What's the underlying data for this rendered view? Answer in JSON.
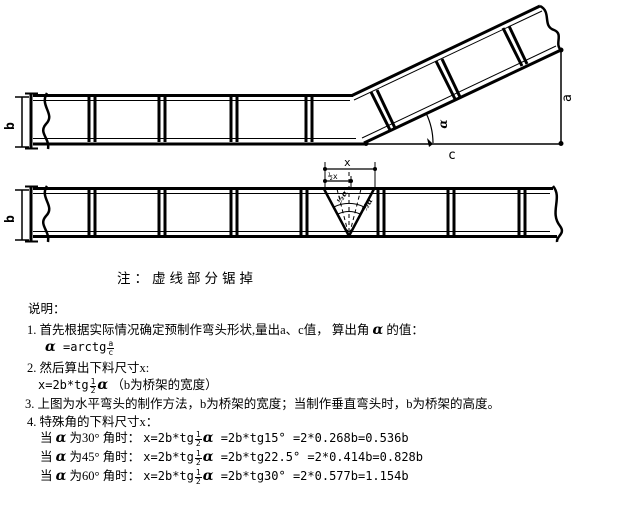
{
  "note": "注：虚线部分锯掉",
  "diagram": {
    "top": {
      "b": "b",
      "a": "a",
      "c": "c",
      "alpha": "α"
    },
    "bottom": {
      "b": "b",
      "x": "x",
      "half_x": "½x",
      "half_alpha_left": "½α",
      "half_alpha_right": "½α"
    }
  },
  "explain": {
    "heading": "说明：",
    "item1": {
      "pre": "1. 首先根据实际情况确定预制作弯头形状,量出a、c值， 算出角 ",
      "alpha": "α",
      "post": " 的值："
    },
    "formula1": {
      "alpha": "α",
      "eq": " =arctg",
      "num": "a",
      "den": "c"
    },
    "item2": "2. 然后算出下料尺寸x:",
    "formula2": {
      "pre": "x=2b*tg",
      "num": "1",
      "den": "2",
      "alpha": "α",
      "post": " （b为桥架的宽度）"
    },
    "item3": "3. 上图为水平弯头的制作方法，b为桥架的宽度；当制作垂直弯头时，b为桥架的高度。",
    "item4": "4. 特殊角的下料尺寸x：",
    "rows": [
      {
        "pre": "当 ",
        "alpha": "α",
        "mid": " 为30° 角时： ",
        "f_pre": "x=2b*tg",
        "num": "1",
        "den": "2",
        "alpha2": "α",
        "post": " =2b*tg15° =2*0.268b=0.536b"
      },
      {
        "pre": "当 ",
        "alpha": "α",
        "mid": " 为45° 角时： ",
        "f_pre": "x=2b*tg",
        "num": "1",
        "den": "2",
        "alpha2": "α",
        "post": " =2b*tg22.5° =2*0.414b=0.828b"
      },
      {
        "pre": "当 ",
        "alpha": "α",
        "mid": " 为60° 角时： ",
        "f_pre": "x=2b*tg",
        "num": "1",
        "den": "2",
        "alpha2": "α",
        "post": " =2b*tg30° =2*0.577b=1.154b"
      }
    ]
  }
}
